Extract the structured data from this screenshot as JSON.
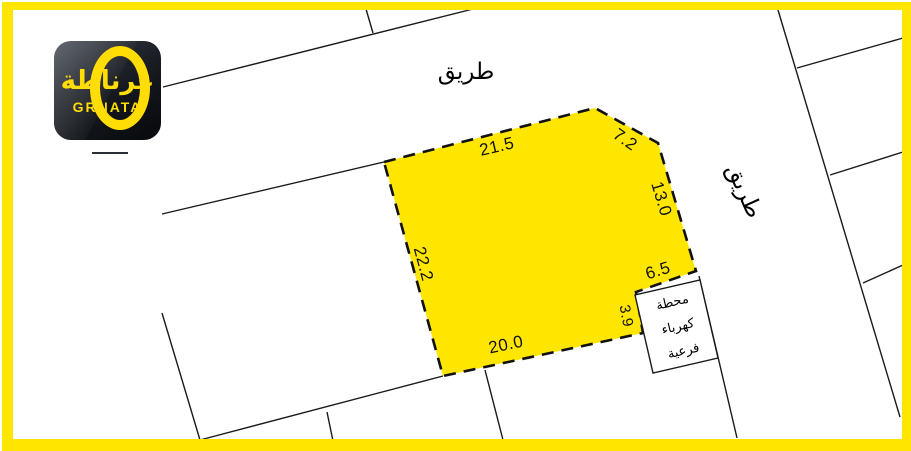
{
  "colors": {
    "frame_yellow": "#FFE600",
    "plot_fill": "#FFE600",
    "line_black": "#1A1A1A",
    "logo_accent": "#FFDD05",
    "logo_bg_dark": "#0B0D10"
  },
  "logo": {
    "arabic": "غرناطة",
    "latin": "GRNATA"
  },
  "roads": {
    "top_label": "طريق",
    "right_label": "طريق"
  },
  "plot": {
    "dimensions": [
      {
        "edge": "top",
        "value": "21.5"
      },
      {
        "edge": "top-right-bevel",
        "value": "7.2"
      },
      {
        "edge": "right",
        "value": "13.0"
      },
      {
        "edge": "notch-top",
        "value": "6.5"
      },
      {
        "edge": "notch-side",
        "value": "3.9"
      },
      {
        "edge": "bottom",
        "value": "20.0"
      },
      {
        "edge": "left",
        "value": "22.2"
      }
    ]
  },
  "substation": {
    "lines": [
      "محطة",
      "كهرباء",
      "فرعية"
    ]
  }
}
